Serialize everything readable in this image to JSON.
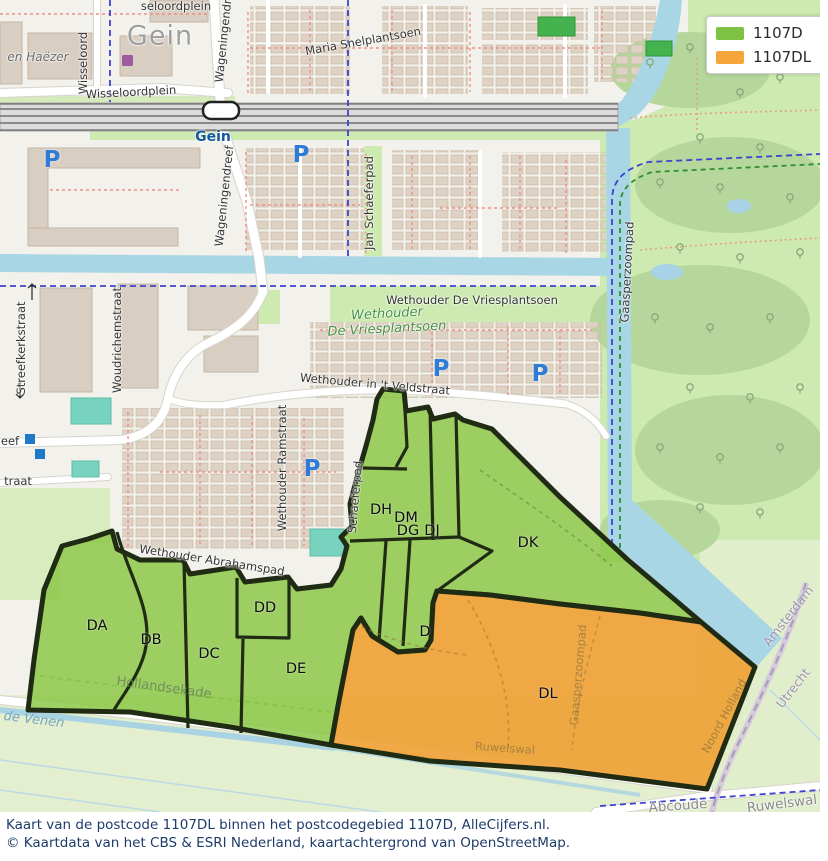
{
  "legend": {
    "items": [
      {
        "label": "1107D",
        "color": "#7dc243"
      },
      {
        "label": "1107DL",
        "color": "#f5a63b"
      }
    ]
  },
  "caption": {
    "line1": "Kaart van de postcode 1107DL binnen het postcodegebied 1107D, AlleCijfers.nl.",
    "line2": "© Kaartdata van het CBS & ESRI Nederland, kaartachtergrond van OpenStreetMap."
  },
  "map": {
    "parking_symbol": "P",
    "parking_positions": [
      {
        "x": 52,
        "y": 160
      },
      {
        "x": 301,
        "y": 155
      },
      {
        "x": 441,
        "y": 369
      },
      {
        "x": 540,
        "y": 374
      },
      {
        "x": 312,
        "y": 469
      }
    ],
    "street_labels": [
      {
        "t": "Gein",
        "x": 160,
        "y": 36,
        "r": 0,
        "c": "place-lg"
      },
      {
        "t": "seloordplein",
        "x": 176,
        "y": 6,
        "r": 0,
        "c": ""
      },
      {
        "t": "en Haëzer",
        "x": 38,
        "y": 57,
        "r": 0,
        "c": "st-it"
      },
      {
        "t": "Wisseloord",
        "x": 83,
        "y": 63,
        "r": -90,
        "c": ""
      },
      {
        "t": "Wisseloordplein",
        "x": 131,
        "y": 92,
        "r": -3,
        "c": ""
      },
      {
        "t": "Gein",
        "x": 213,
        "y": 137,
        "r": 0,
        "c": "station"
      },
      {
        "t": "Wageningendreef",
        "x": 224,
        "y": 32,
        "r": -84,
        "c": ""
      },
      {
        "t": "Wageningendreef",
        "x": 224,
        "y": 196,
        "r": -84,
        "c": ""
      },
      {
        "t": "Maria Snelplantsoen",
        "x": 363,
        "y": 41,
        "r": -10,
        "c": ""
      },
      {
        "t": "Jan Schaeferpad",
        "x": 369,
        "y": 203,
        "r": -90,
        "c": ""
      },
      {
        "t": "Streefkerkstraat",
        "x": 21,
        "y": 348,
        "r": -90,
        "c": ""
      },
      {
        "t": "Woudrichemstraat",
        "x": 117,
        "y": 340,
        "r": -90,
        "c": ""
      },
      {
        "t": "Wethouder De Vriesplantsoen",
        "x": 472,
        "y": 300,
        "r": 0,
        "c": ""
      },
      {
        "t": "Wethouder",
        "x": 387,
        "y": 314,
        "r": -3,
        "c": "park"
      },
      {
        "t": "De Vriesplantsoen",
        "x": 387,
        "y": 329,
        "r": -3,
        "c": "park"
      },
      {
        "t": "Wethouder in 't Veldstraat",
        "x": 375,
        "y": 384,
        "r": 5,
        "c": ""
      },
      {
        "t": "Wethouder Ramstraat",
        "x": 282,
        "y": 468,
        "r": -90,
        "c": ""
      },
      {
        "t": "Schaeferpad",
        "x": 355,
        "y": 497,
        "r": -85,
        "c": ""
      },
      {
        "t": "Wethouder Abrahamspad",
        "x": 212,
        "y": 560,
        "r": 9,
        "c": ""
      },
      {
        "t": "Hollandsekade",
        "x": 164,
        "y": 688,
        "r": 8,
        "c": "faded-green"
      },
      {
        "t": "de Venen",
        "x": 34,
        "y": 720,
        "r": 7,
        "c": "water-it"
      },
      {
        "t": "Gaasperzoompad",
        "x": 627,
        "y": 272,
        "r": -87,
        "c": ""
      },
      {
        "t": "Gaasperzoompad",
        "x": 578,
        "y": 675,
        "r": -85,
        "c": "faded"
      },
      {
        "t": "Ruwelswal",
        "x": 505,
        "y": 748,
        "r": 4,
        "c": "faded"
      },
      {
        "t": "Ruwelswal",
        "x": 782,
        "y": 804,
        "r": -7,
        "c": "gray-pl"
      },
      {
        "t": "Abcoude",
        "x": 678,
        "y": 806,
        "r": -4,
        "c": "gray-pl"
      },
      {
        "t": "Amsterdam",
        "x": 788,
        "y": 616,
        "r": -52,
        "c": "admin"
      },
      {
        "t": "Utrecht",
        "x": 793,
        "y": 688,
        "r": -52,
        "c": "admin"
      },
      {
        "t": "Noord Holland",
        "x": 724,
        "y": 716,
        "r": -62,
        "c": "faded"
      },
      {
        "t": "eef",
        "x": 10,
        "y": 441,
        "r": 0,
        "c": ""
      },
      {
        "t": "traat",
        "x": 18,
        "y": 481,
        "r": 0,
        "c": ""
      }
    ],
    "region_labels": [
      {
        "code": "DA",
        "x": 97,
        "y": 626
      },
      {
        "code": "DB",
        "x": 151,
        "y": 640
      },
      {
        "code": "DC",
        "x": 209,
        "y": 654
      },
      {
        "code": "DD",
        "x": 265,
        "y": 608
      },
      {
        "code": "DE",
        "x": 296,
        "y": 669
      },
      {
        "code": "DH",
        "x": 381,
        "y": 510
      },
      {
        "code": "DM",
        "x": 406,
        "y": 518
      },
      {
        "code": "DG",
        "x": 408,
        "y": 531
      },
      {
        "code": "DJ",
        "x": 432,
        "y": 531
      },
      {
        "code": "DK",
        "x": 528,
        "y": 543
      },
      {
        "code": "D",
        "x": 425,
        "y": 632
      },
      {
        "code": "DL",
        "x": 548,
        "y": 694
      }
    ],
    "colors": {
      "highlight_green": "#8cc63f",
      "highlight_orange": "#f0a43a",
      "boundary": "#202b13",
      "water": "#a9d6e5",
      "grass": "#cdeab0",
      "building": "#ddd2c4",
      "caption_text": "#1e3c69"
    }
  }
}
